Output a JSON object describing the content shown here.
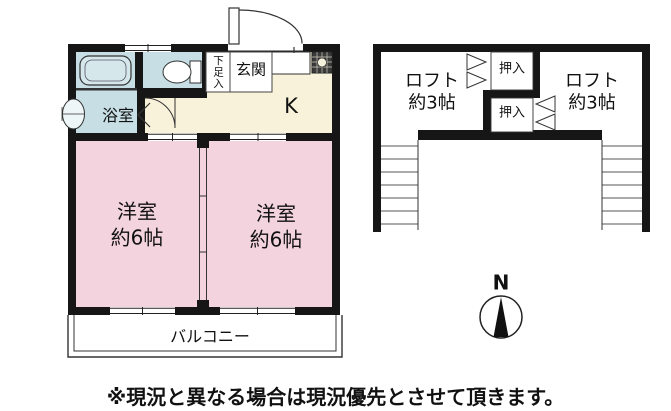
{
  "floorplan": {
    "first_floor": {
      "bathroom_label": "浴室",
      "entrance_label": "玄関",
      "shoe_box_label": "下足入",
      "kitchen_label": "K",
      "room_left": {
        "name": "洋室",
        "size": "約6帖"
      },
      "room_right": {
        "name": "洋室",
        "size": "約6帖"
      },
      "balcony_label": "バルコニー"
    },
    "loft_floor": {
      "loft_left": {
        "name": "ロフト",
        "size": "約3帖"
      },
      "loft_right": {
        "name": "ロフト",
        "size": "約3帖"
      },
      "closet_top_label": "押入",
      "closet_bottom_label": "押入"
    },
    "compass_label": "N",
    "disclaimer": "※現況と異なる場合は現況優先とさせて頂きます。"
  },
  "icons": [
    "bathtub-icon",
    "washbasin-icon",
    "toilet-icon",
    "kitchen-sink-icon",
    "stove-icon",
    "entrance-door-arc-icon",
    "toilet-door-arc-icon",
    "folding-door-icon",
    "bifold-closet-door-icon",
    "ladder-icon",
    "compass-icon",
    "window-icon",
    "sliding-partition-icon"
  ],
  "colors": {
    "wall": "#161616",
    "wet_area": "#c6dee4",
    "kitchen_floor": "#f8f2da",
    "room_floor": "#f3d3de",
    "outline": "#333333",
    "background": "#ffffff"
  }
}
